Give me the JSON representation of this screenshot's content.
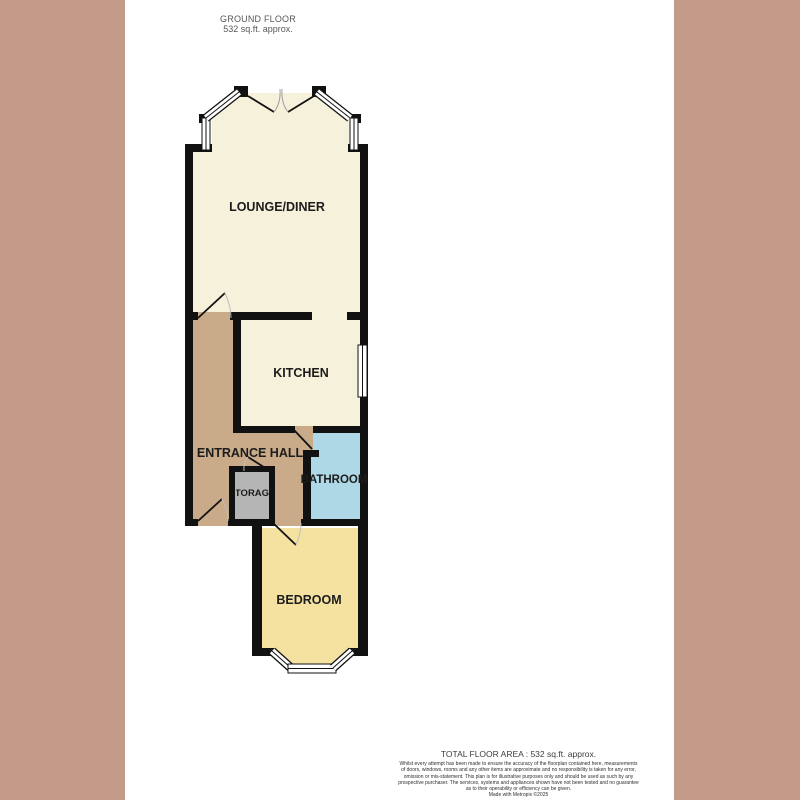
{
  "canvas": {
    "background": "#ffffff",
    "margin_color": "#c49a89"
  },
  "header": {
    "title": "GROUND FLOOR",
    "subtitle": "532 sq.ft. approx."
  },
  "floorplan": {
    "wall_color": "#111111",
    "rooms": {
      "lounge": {
        "label": "LOUNGE/DINER",
        "color": "#f6f1db"
      },
      "kitchen": {
        "label": "KITCHEN",
        "color": "#f6f1db"
      },
      "hall": {
        "label": "ENTRANCE HALL",
        "color": "#c9ab8a"
      },
      "bathroom": {
        "label": "BATHROOM",
        "color": "#aed8e6"
      },
      "storage": {
        "label": "STORAGE",
        "color": "#b5b5b5"
      },
      "bedroom": {
        "label": "BEDROOM",
        "color": "#f5e2a1"
      }
    }
  },
  "footer": {
    "title": "TOTAL FLOOR AREA : 532 sq.ft. approx.",
    "disclaimer_lines": [
      "Whilst every attempt has been made to ensure the accuracy of the floorplan contained here, measurements",
      "of doors, windows, rooms and any other items are approximate and no responsibility is taken for any error,",
      "omission or mis-statement. This plan is for illustrative purposes only and should be used as such by any",
      "prospective purchaser. The services, systems and appliances shown have not been tested and no guarantee",
      "as to their operability or efficiency can be given."
    ],
    "credit": "Made with Metropix ©2025"
  }
}
